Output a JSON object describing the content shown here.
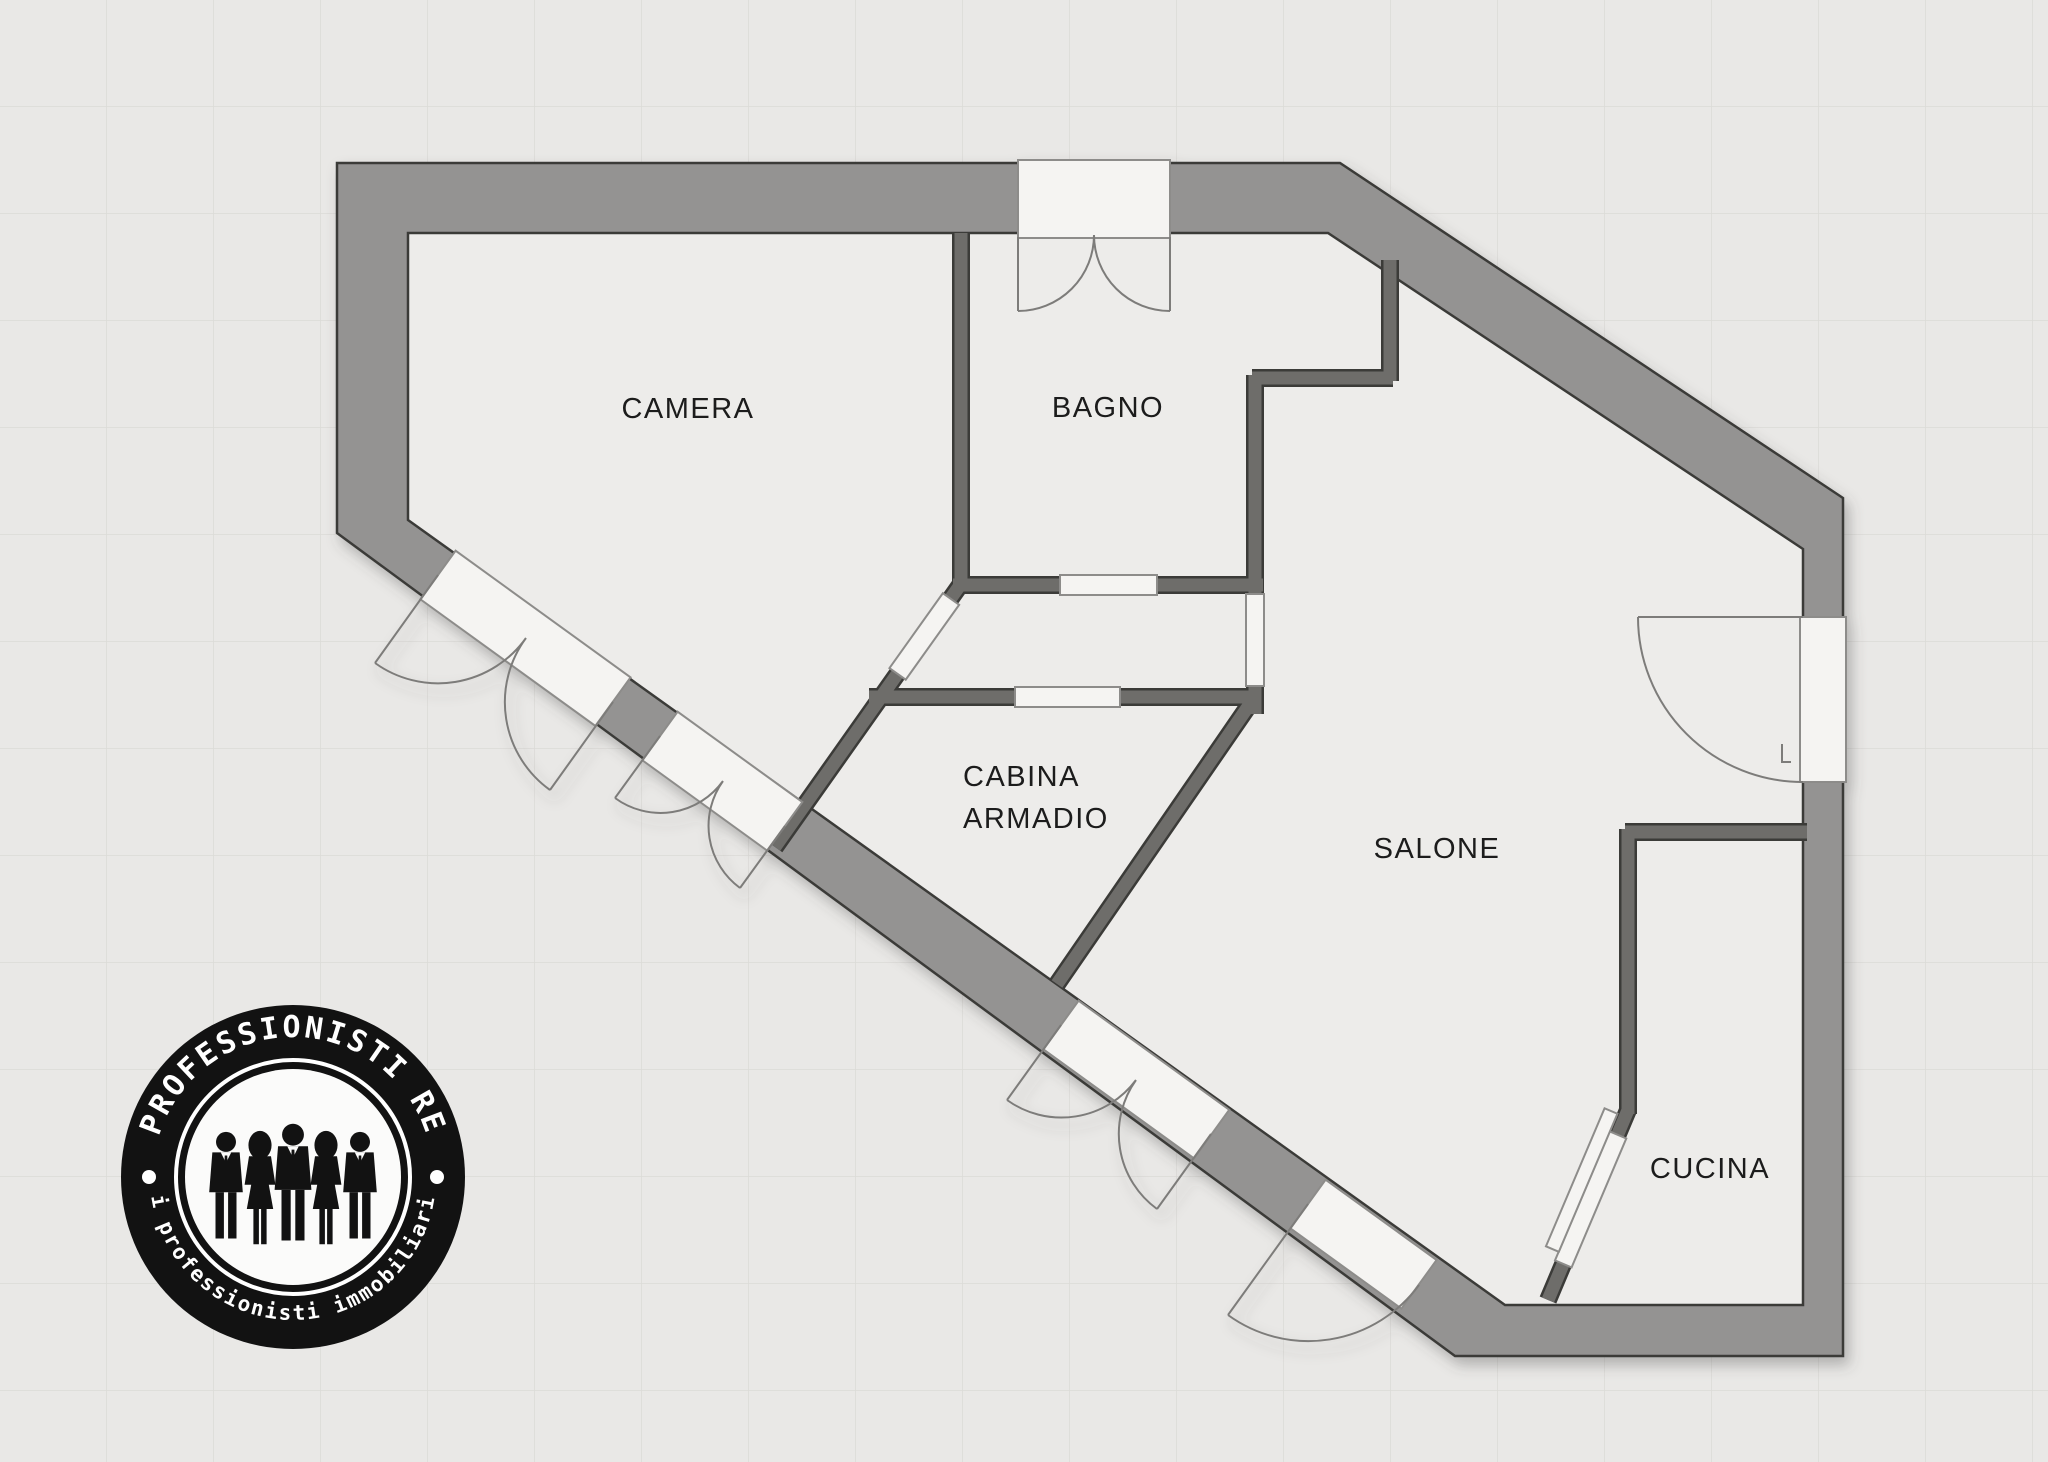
{
  "document": {
    "type": "floor-plan"
  },
  "rooms": [
    {
      "id": "camera",
      "label": "CAMERA",
      "x": 688,
      "y": 418,
      "align": "middle"
    },
    {
      "id": "bagno",
      "label": "BAGNO",
      "x": 1108,
      "y": 417,
      "align": "middle"
    },
    {
      "id": "cabina-armadio",
      "label": "CABINA ARMADIO",
      "lines": [
        "CABINA",
        "ARMADIO"
      ],
      "x": 963,
      "y": 786,
      "line_height": 42,
      "align": "start"
    },
    {
      "id": "salone",
      "label": "SALONE",
      "x": 1437,
      "y": 858,
      "align": "middle"
    },
    {
      "id": "cucina",
      "label": "CUCINA",
      "x": 1710,
      "y": 1178,
      "align": "middle"
    }
  ],
  "logo": {
    "top_text": "PROFESSIONISTI RE",
    "bottom_text": "i professionisti immobiliari"
  },
  "colors": {
    "background": "#e9e8e6",
    "floor": "#edecea",
    "outer_wall": "#949392",
    "inner_wall": "#6e6d6b",
    "wall_outline": "#3b3a38",
    "opening_fill": "#f5f4f2",
    "door_line": "#7d7c7a",
    "logo_ink": "#121212"
  }
}
